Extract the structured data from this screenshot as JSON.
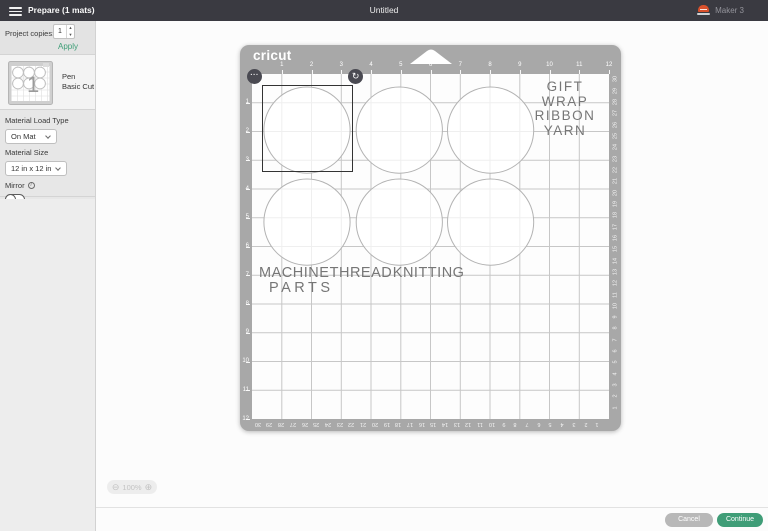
{
  "colors": {
    "accent_green": "#3E9E77",
    "topbar_bg": "#3A3A41",
    "mat_gray": "#A8A8A8",
    "machine_red": "#D9512C",
    "selection": "#333333"
  },
  "icons": {
    "menu": "hamburger-icon",
    "machine": "machine-status-icon",
    "more_options": "···",
    "rotate": "↻",
    "zoom_out": "⊖",
    "zoom_in": "⊕",
    "info": "i",
    "stepper_up": "▲",
    "stepper_down": "▼"
  },
  "topbar": {
    "title": "Prepare (1 mats)",
    "document_title": "Untitled",
    "machine_name": "Maker 3"
  },
  "sidebar": {
    "project_copies": {
      "label": "Project copies:",
      "value": "1",
      "apply_label": "Apply"
    },
    "mat_item": {
      "badge": "1",
      "tool": "Pen",
      "operation": "Basic Cut"
    },
    "material_load_type": {
      "label": "Material Load Type",
      "value": "On Mat"
    },
    "material_size": {
      "label": "Material Size",
      "value": "12 in x 12 in"
    },
    "mirror": {
      "label": "Mirror",
      "state": "off"
    }
  },
  "mat": {
    "brand": "cricut",
    "ruler_top": [
      "1",
      "2",
      "3",
      "4",
      "5",
      "6",
      "7",
      "8",
      "9",
      "10",
      "11",
      "12"
    ],
    "ruler_left": [
      "1",
      "2",
      "3",
      "4",
      "5",
      "6",
      "7",
      "8",
      "9",
      "10",
      "11",
      "12"
    ],
    "ruler_right_cm": [
      "30",
      "29",
      "28",
      "27",
      "26",
      "25",
      "24",
      "23",
      "22",
      "21",
      "20",
      "19",
      "18",
      "17",
      "16",
      "15",
      "14",
      "13",
      "12",
      "11",
      "10",
      "9",
      "8",
      "7",
      "6",
      "5",
      "4",
      "3",
      "2",
      "1"
    ],
    "ruler_bottom_cm": [
      "30",
      "29",
      "28",
      "27",
      "26",
      "25",
      "24",
      "23",
      "22",
      "21",
      "20",
      "19",
      "18",
      "17",
      "16",
      "15",
      "14",
      "13",
      "12",
      "11",
      "10",
      "9",
      "8",
      "7",
      "6",
      "5",
      "4",
      "3",
      "2",
      "1"
    ],
    "word_group_top_right": [
      "GIFT",
      "WRAP",
      "RIBBON",
      "YARN"
    ],
    "word_group_bottom": [
      "MACHINE THREAD KNITTING",
      "PARTS"
    ],
    "circles": [
      {
        "cx_in": 1.85,
        "cy_in": 1.95,
        "r_in": 1.45
      },
      {
        "cx_in": 4.95,
        "cy_in": 1.95,
        "r_in": 1.45
      },
      {
        "cx_in": 8.02,
        "cy_in": 1.95,
        "r_in": 1.45
      },
      {
        "cx_in": 1.85,
        "cy_in": 5.15,
        "r_in": 1.45
      },
      {
        "cx_in": 4.95,
        "cy_in": 5.15,
        "r_in": 1.45
      },
      {
        "cx_in": 8.02,
        "cy_in": 5.15,
        "r_in": 1.45
      }
    ],
    "selection": {
      "x_in": 0.34,
      "y_in": 0.38,
      "w_in": 3.06,
      "h_in": 3.03
    }
  },
  "canvas": {
    "zoom_level": "100%"
  },
  "footer": {
    "cancel_label": "Cancel",
    "continue_label": "Continue"
  }
}
